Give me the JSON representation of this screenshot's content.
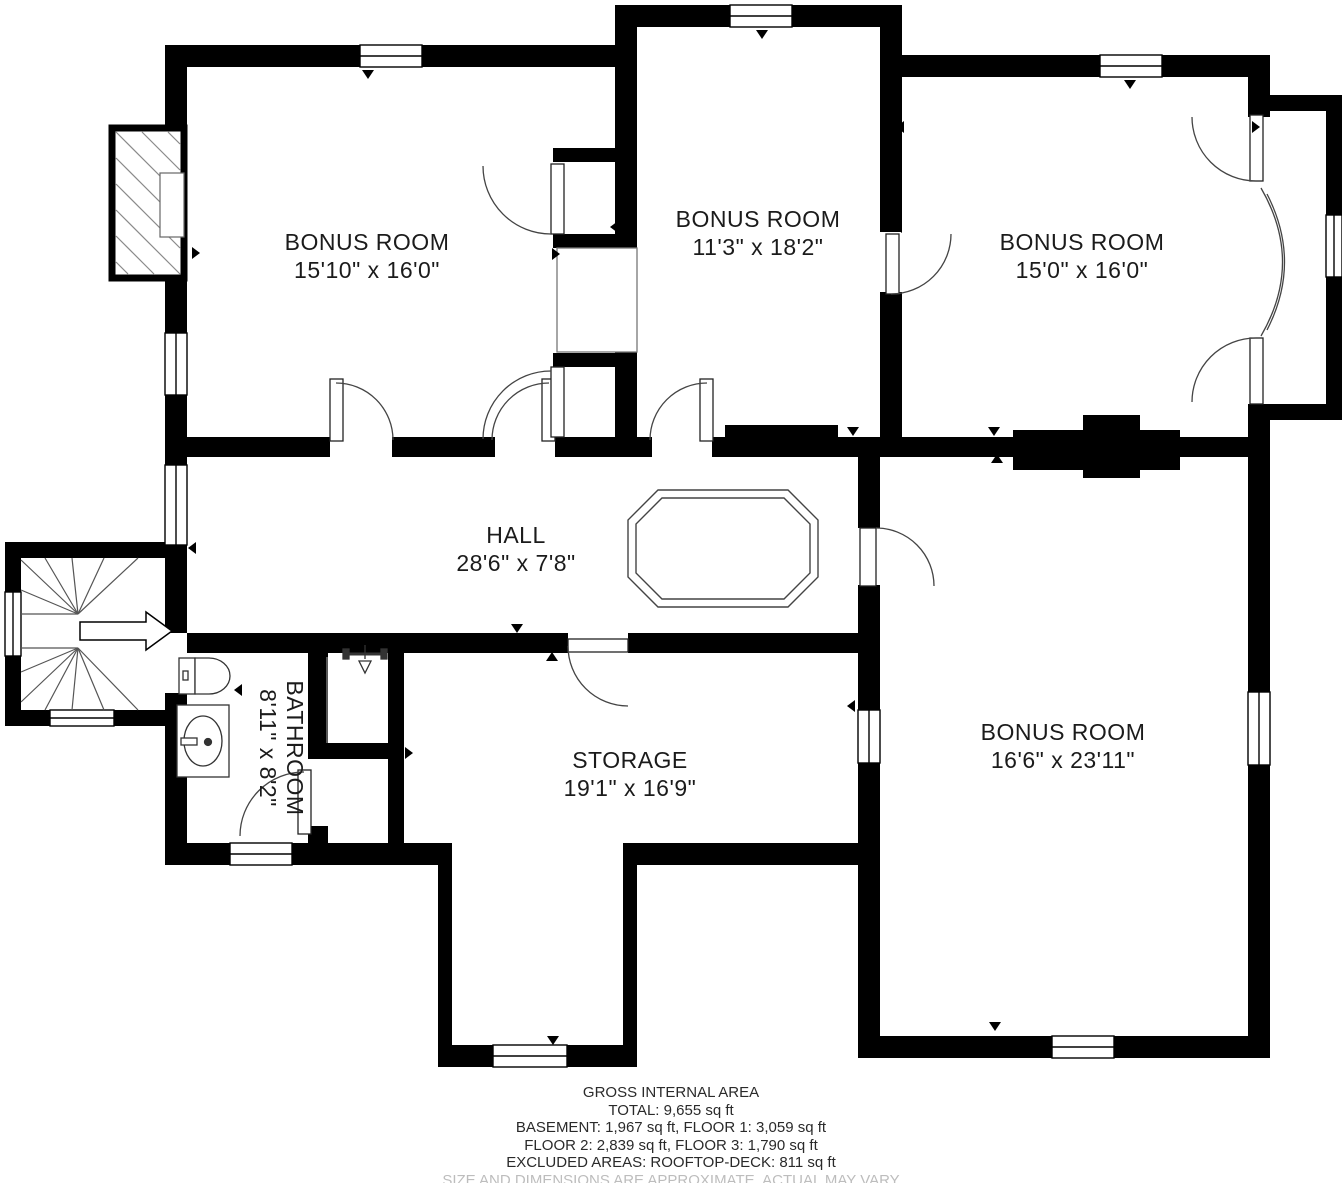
{
  "rooms": [
    {
      "id": "bonus-top-left",
      "name": "BONUS ROOM",
      "dims": "15'10\" x 16'0\""
    },
    {
      "id": "bonus-top-middle",
      "name": "BONUS ROOM",
      "dims": "11'3\" x 18'2\""
    },
    {
      "id": "bonus-top-right",
      "name": "BONUS ROOM",
      "dims": "15'0\" x 16'0\""
    },
    {
      "id": "hall",
      "name": "HALL",
      "dims": "28'6\" x 7'8\""
    },
    {
      "id": "bathroom",
      "name": "BATHROOM",
      "dims": "8'11\" x 8'2\""
    },
    {
      "id": "storage",
      "name": "STORAGE",
      "dims": "19'1\" x 16'9\""
    },
    {
      "id": "bonus-lower-right",
      "name": "BONUS ROOM",
      "dims": "16'6\" x 23'11\""
    }
  ],
  "footer": {
    "title": "GROSS INTERNAL AREA",
    "total": "TOTAL: 9,655 sq ft",
    "line_basement_floor1": "BASEMENT: 1,967 sq ft, FLOOR 1: 3,059 sq ft",
    "line_floor2_floor3": "FLOOR 2: 2,839 sq ft, FLOOR 3: 1,790 sq ft",
    "line_excluded": "EXCLUDED AREAS: ROOFTOP-DECK: 811 sq ft",
    "disclaimer": "SIZE AND DIMENSIONS ARE APPROXIMATE, ACTUAL MAY VARY"
  },
  "colors": {
    "wall": "#000000",
    "background": "#ffffff",
    "thin_line": "#555555",
    "label_text": "#1b1b1b",
    "muted_text": "#bdbdbd"
  }
}
